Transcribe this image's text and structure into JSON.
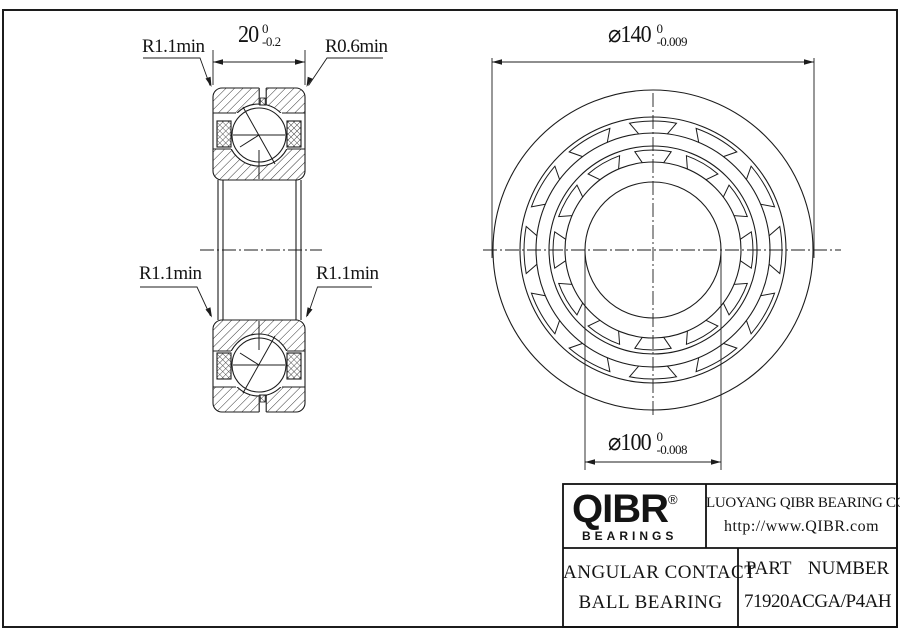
{
  "drawing": {
    "section_view": {
      "width_dim": {
        "value": "20",
        "tol_upper": "0",
        "tol_lower": "-0.2"
      },
      "radius_top_left": "R1.1min",
      "radius_top_right": "R0.6min",
      "radius_mid_left": "R1.1min",
      "radius_mid_right": "R1.1min"
    },
    "front_view": {
      "outer_dia_dim": {
        "value": "⌀140",
        "tol_upper": "0",
        "tol_lower": "-0.009"
      },
      "bore_dia_dim": {
        "value": "⌀100",
        "tol_upper": "0",
        "tol_lower": "-0.008"
      }
    }
  },
  "title_block": {
    "logo_text": "QIBR",
    "logo_registered": "®",
    "logo_subtext": "BEARINGS",
    "company_name": "LUOYANG QIBR BEARING CO. , LTD",
    "website": "http://www.QIBR.com",
    "product_line1": "ANGULAR CONTACT",
    "product_line2": "BALL BEARING",
    "part_number_label": "PART NUMBER",
    "part_number": "71920ACGA/P4AH"
  },
  "colors": {
    "line": "#1c1c1c",
    "background": "#ffffff"
  }
}
